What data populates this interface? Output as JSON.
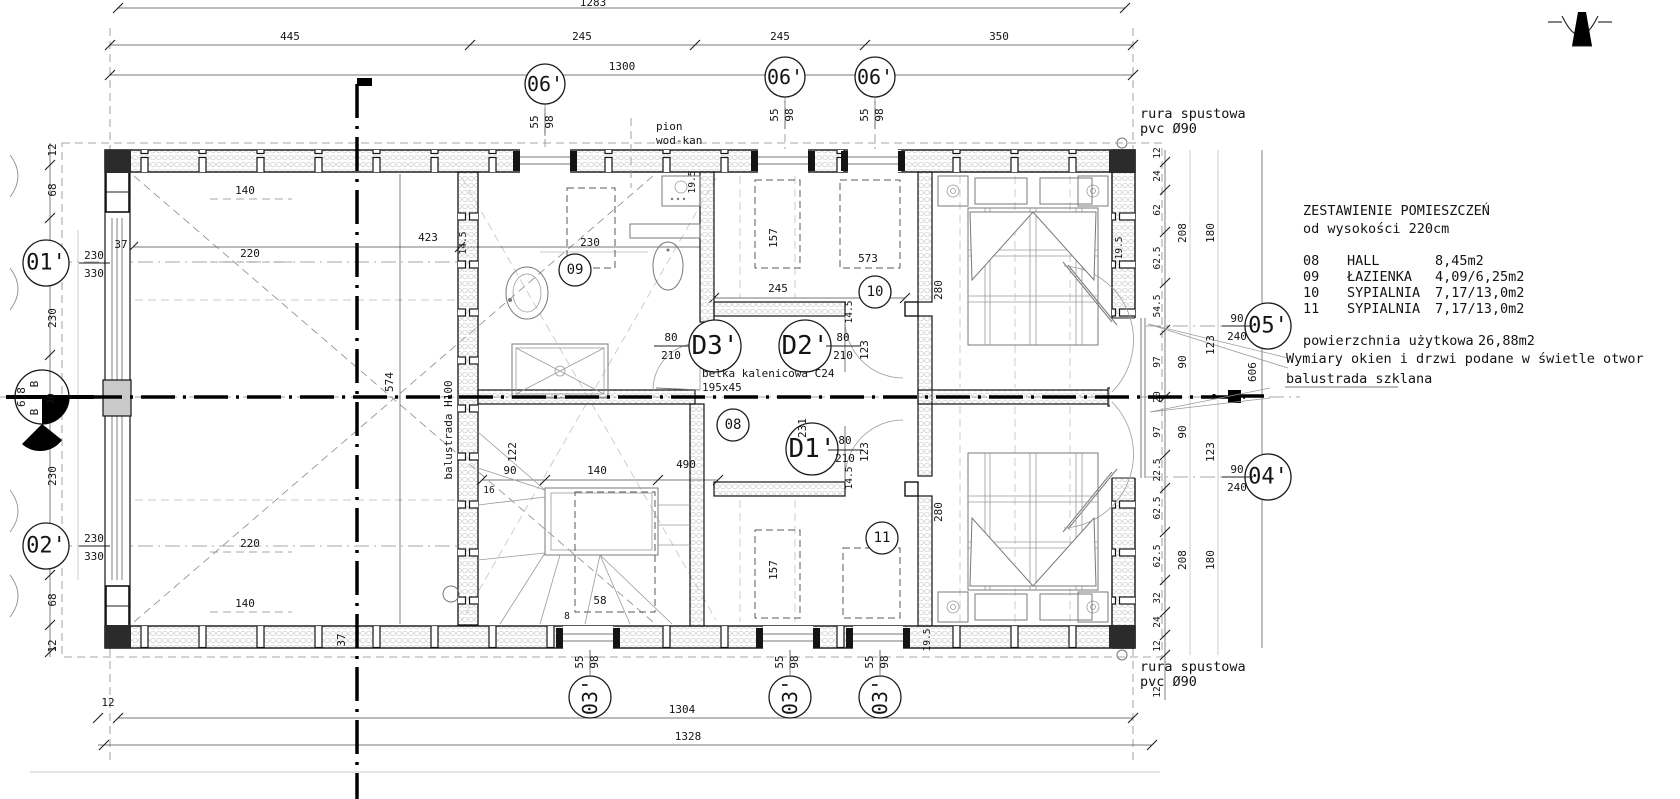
{
  "legend": {
    "title": "ZESTAWIENIE POMIESZCZEŃ",
    "subtitle": "od wysokości 220cm",
    "rows": [
      {
        "no": "08",
        "name": "HALL",
        "area": "8,45m2"
      },
      {
        "no": "09",
        "name": "ŁAZIENKA",
        "area": "4,09/6,25m2"
      },
      {
        "no": "10",
        "name": "SYPIALNIA",
        "area": "7,17/13,0m2"
      },
      {
        "no": "11",
        "name": "SYPIALNIA",
        "area": "7,17/13,0m2"
      }
    ],
    "total_label": "powierzchnia użytkowa",
    "total_value": "26,88m2",
    "note1": "Wymiary okien i drzwi podane w świetle otwor",
    "note2": "balustrada szklana"
  },
  "notes": {
    "downpipe1": "rura spustowa",
    "downpipe2": "pvc Ø90",
    "riser1": "pion",
    "riser2": "wod-kan",
    "ridge1": "belka kalenicowa C24",
    "ridge2": "195x45",
    "balustrade_int": "balustrada H100"
  },
  "callouts": {
    "w06": {
      "id": "06'",
      "a": "55",
      "b": "98"
    },
    "w03": {
      "id": "03'",
      "a": "55",
      "b": "98"
    },
    "a01": {
      "id": "01'",
      "a": "230",
      "b": "330"
    },
    "a02": {
      "id": "02'",
      "a": "230",
      "b": "330"
    },
    "a04": {
      "id": "04'",
      "a": "90",
      "b": "240"
    },
    "a05": {
      "id": "05'",
      "a": "90",
      "b": "240"
    },
    "d1": {
      "id": "D1'",
      "a": "80",
      "b": "210"
    },
    "d2": {
      "id": "D2'",
      "a": "80",
      "b": "210"
    },
    "d3": {
      "id": "D3'",
      "a": "80",
      "b": "210"
    },
    "r08": "08",
    "r09": "09",
    "r10": "10",
    "r11": "11"
  },
  "section": {
    "letter": "B",
    "sheet": "6,8",
    "depth": "30"
  },
  "dims": {
    "top": [
      "1283",
      "445",
      "245",
      "245",
      "350",
      "1300"
    ],
    "bottom": [
      "1304",
      "1328",
      "12",
      "12"
    ],
    "left": [
      "12",
      "68",
      "230",
      "230",
      "68",
      "12"
    ],
    "wall37": "37",
    "interior": {
      "v423": "423",
      "v220": "220",
      "v140": "140",
      "v574": "574",
      "bath230": "230",
      "hall245": "245",
      "beam231": "231",
      "bed280": "280",
      "ward157": "157",
      "ward573": "573",
      "stair122": "122",
      "stair90": "90",
      "stair140": "140",
      "stair490": "490",
      "stair16": "16",
      "stair58": "58",
      "stair8": "8",
      "t145": "14.5",
      "t195": "19.5"
    },
    "right": {
      "s12": "12",
      "s24": "24",
      "s62": "62",
      "s625": "62.5",
      "s545": "54.5",
      "s97": "97",
      "s90": "90",
      "s20": "20",
      "s225": "22.5",
      "s32": "32",
      "s123": "123",
      "s180": "180",
      "s208": "208",
      "s606": "606"
    }
  }
}
